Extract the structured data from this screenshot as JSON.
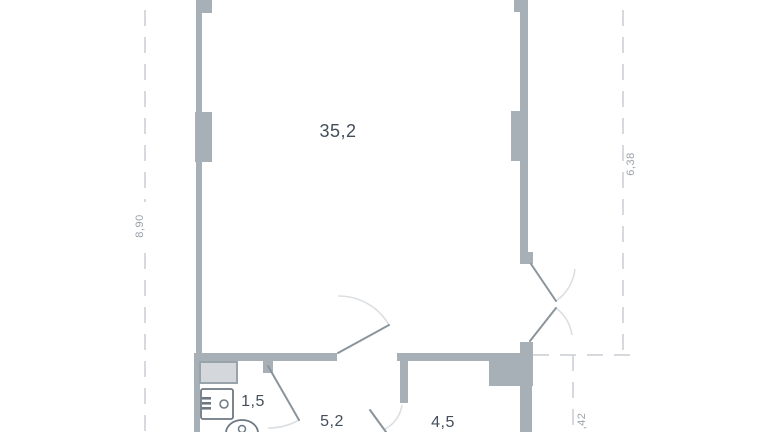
{
  "plan": {
    "type": "apartment floor plan",
    "rooms": [
      {
        "id": "living",
        "area_label": "35,2"
      },
      {
        "id": "bathroom",
        "area_label": "1,5"
      },
      {
        "id": "hallway",
        "area_label": "5,2"
      },
      {
        "id": "room2",
        "area_label": "4,5"
      }
    ],
    "dimensions": {
      "left_vertical": "8,90",
      "right_vertical": "6,38",
      "bottom_right_vertical": ",42"
    },
    "colors": {
      "background": "#ffffff",
      "wall": "#a7b0b7",
      "shaft_fill": "#d4d8dc",
      "shaft_stroke": "#99a3ab",
      "fixture_stroke": "#6e7882",
      "door_line": "#8a949c",
      "arc_line": "#dcdfe2",
      "dashed_line": "#c9ced3",
      "room_text": "#434e5a",
      "dim_text": "#9aa3ab"
    }
  }
}
